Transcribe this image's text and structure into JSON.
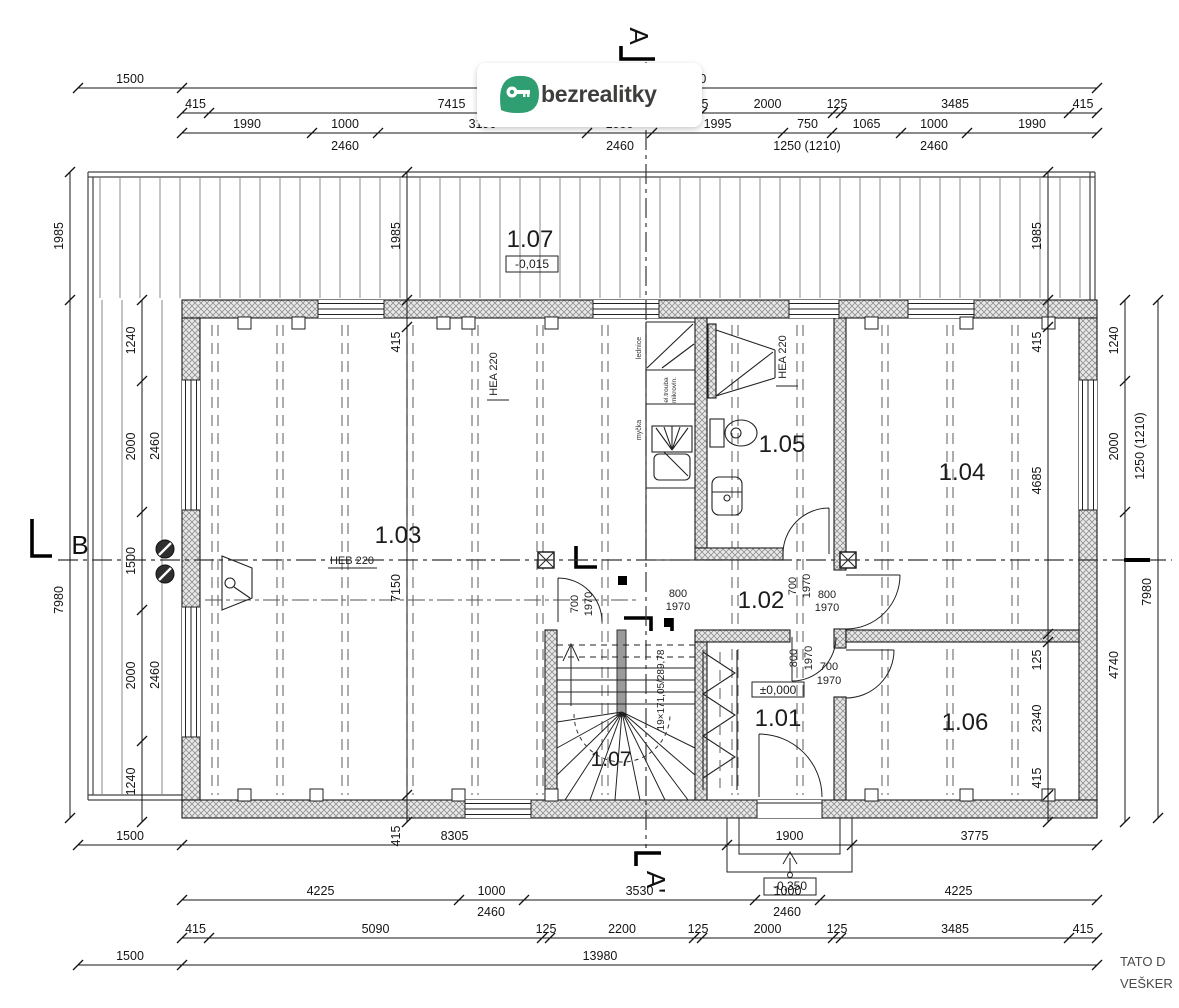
{
  "brand": {
    "logo_text": "bezrealitky",
    "logo_green": "#2f9e70"
  },
  "section_markers": {
    "top": "A",
    "bottom": "A'",
    "left": "B"
  },
  "rooms": {
    "deck": {
      "label": "1.07",
      "level": "-0,015"
    },
    "living": {
      "label": "1.03"
    },
    "hall": {
      "label": "1.02"
    },
    "bath": {
      "label": "1.05"
    },
    "room104": {
      "label": "1.04"
    },
    "entry": {
      "label": "1.01",
      "level": "±0,000"
    },
    "room106": {
      "label": "1.06"
    },
    "stairs": {
      "label": "1.07"
    }
  },
  "levels": {
    "porch": "-0,350"
  },
  "beams": {
    "hea_left": "HEA 220",
    "hea_right": "HEA 220",
    "heb": "HEB 220"
  },
  "stair_note": "19×171,05/289,78",
  "kitchen": {
    "fridge": "lednice",
    "oven_line1": "el.trouba",
    "oven_line2": "mikrovln.",
    "dishwasher": "myčka"
  },
  "door_dims": {
    "c1": [
      "700",
      "1970"
    ],
    "c2": [
      "800",
      "1970"
    ],
    "c3": [
      "700",
      "1970"
    ],
    "c4": [
      "800",
      "1970"
    ],
    "c5": [
      "800",
      "1970"
    ],
    "c6": [
      "700",
      "1970"
    ]
  },
  "dims": {
    "top1": [
      "1500",
      "13980"
    ],
    "top2": [
      "415",
      "7415",
      "125",
      "2000",
      "125",
      "3485",
      "415"
    ],
    "top3": [
      "1990",
      "1000",
      "3190",
      "1000",
      "1995",
      "750",
      "1065",
      "1000",
      "1990"
    ],
    "top3_subs": [
      "2460",
      "2460",
      "1250 (1210)",
      "2460"
    ],
    "left_outer": [
      "1985",
      "7980"
    ],
    "left_inner": [
      "1240",
      "2000",
      "1500",
      "2000",
      "1240"
    ],
    "left_inner_subs": [
      "2460",
      "2460"
    ],
    "col_left": [
      "1985",
      "415",
      "7150",
      "415"
    ],
    "col_right": [
      "1985",
      "415",
      "4685",
      "125",
      "2340",
      "415"
    ],
    "right_outer": [
      "1240",
      "2000",
      "4740"
    ],
    "right_outer_sub": "1250 (1210)",
    "right_far": [
      "7980"
    ],
    "bottom1": [
      "1500",
      "8305",
      "1900",
      "3775"
    ],
    "bottom2": [
      "4225",
      "1000",
      "3530",
      "1000",
      "4225"
    ],
    "bottom2_subs": [
      "2460",
      "2460"
    ],
    "bottom3": [
      "415",
      "5090",
      "125",
      "2200",
      "125",
      "2000",
      "125",
      "3485",
      "415"
    ],
    "bottom4": [
      "1500",
      "13980"
    ]
  },
  "footer": {
    "line1": "TATO D",
    "line2": "VEŠKER"
  }
}
